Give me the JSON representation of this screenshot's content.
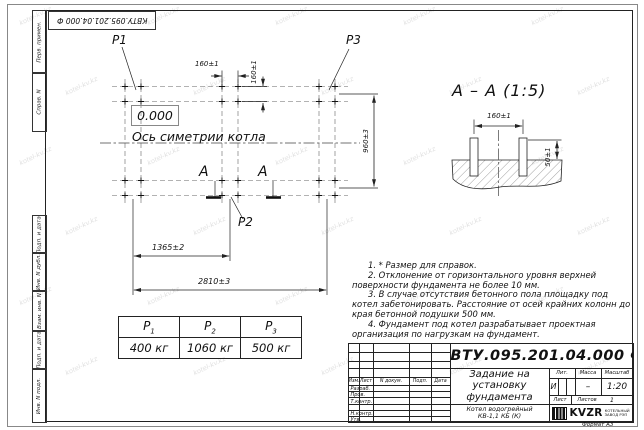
{
  "watermark": "kotel-kv.kz",
  "format_label": "Формат А3",
  "margins": [
    "Перв. примен.",
    "Справ. N",
    "Подп. и дата",
    "Инв. N дубл.",
    "Взам. инв. N",
    "Подп. и дата",
    "Инв. N подл."
  ],
  "plan": {
    "p1": "P1",
    "p2": "P2",
    "p3": "P3",
    "level": "0.000",
    "axis": "Ось симетрии котла",
    "section_letter": "А",
    "dims": {
      "h160": "160±1",
      "v160": "160±1",
      "v960": "960±3",
      "w1365": "1365±2",
      "w2810": "2810±3"
    }
  },
  "section": {
    "title": "А – А (1:5)",
    "d160": "160±1",
    "d50": "50±1"
  },
  "notes": [
    "1. * Размер для справок.",
    "2. Отклонение от горизонтального уровня верхней поверхности фундамента не более 10 мм.",
    "3. В случае отсутствия бетонного пола площадку под котел забетонировать. Расстояние от осей крайних колонн до края бетонной подушки 500 мм.",
    "4. Фундамент под котел разрабатывает проектная организация по нагрузкам на фундамент."
  ],
  "load_table": {
    "cols": [
      {
        "p": "P",
        "sub": "1",
        "value": "400 кг"
      },
      {
        "p": "P",
        "sub": "2",
        "value": "1060 кг"
      },
      {
        "p": "P",
        "sub": "3",
        "value": "500 кг"
      }
    ]
  },
  "title_block": {
    "doc_number": "КВТУ.095.201.04.000  Ф",
    "cols": [
      "Изм.",
      "Лист",
      "N докум.",
      "Подп.",
      "Дата"
    ],
    "rows": [
      "Разраб.",
      "Пров.",
      "Т.контр.",
      "",
      "Н.контр.",
      "Утв."
    ],
    "title_lines": [
      "Задание на",
      "установку",
      "фундамента"
    ],
    "product": [
      "Котел водогрейный",
      "КВ-1,1 КБ (К)"
    ],
    "lit_label": "Лит.",
    "mass_label": "Масса",
    "scale_label": "Масштаб",
    "lit": "И",
    "mass": "–",
    "scale": "1:20",
    "sheet_label": "Лист",
    "sheets_label": "Листов",
    "sheets_value": "1",
    "company": "KVZR",
    "company_line1": "КОТЕЛЬНЫЙ",
    "company_line2": "ЗАВОД РЭП"
  }
}
